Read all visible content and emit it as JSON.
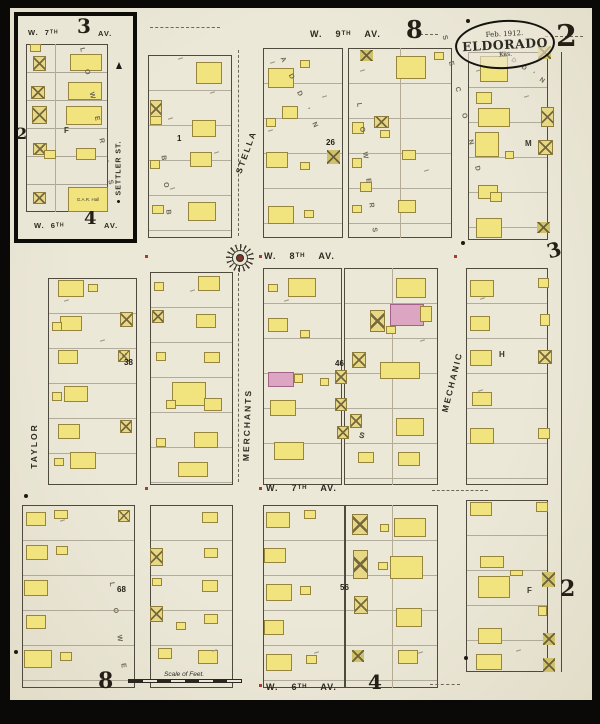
{
  "page": {
    "number": "2"
  },
  "title": {
    "date": "Feb. 1912.",
    "city": "ELDORADO",
    "state": "Kas."
  },
  "streets": {
    "w9": {
      "w": "W.",
      "n": "9ᵀᴴ",
      "av": "AV."
    },
    "w8": {
      "w": "W.",
      "n": "8ᵀᴴ",
      "av": "AV."
    },
    "w7": {
      "w": "W.",
      "n": "7ᵀᴴ",
      "av": "AV."
    },
    "w6": {
      "w": "W.",
      "n": "6ᵀᴴ",
      "av": "AV."
    },
    "w7_inset": {
      "w": "W.",
      "n": "7ᵀᴴ",
      "av": "AV."
    },
    "w6_inset": {
      "w": "W.",
      "n": "6ᵀᴴ",
      "av": "AV."
    }
  },
  "vstreets": {
    "stella": "STELLA",
    "merchants": "MERCHANTS",
    "mechanic": "MECHANIC",
    "taylor": "TAYLOR",
    "settler": "SETTLER ST."
  },
  "nums": {
    "top8": "8",
    "inset3": "3",
    "inset4": "4",
    "inset2": "2",
    "right3": "3",
    "right2": "2",
    "bottom8": "8",
    "bottom4": "4",
    "n1": "1",
    "n26": "26",
    "n38": "38",
    "n46": "46",
    "n56": "56",
    "n68": "68"
  },
  "letters": {
    "m": "M",
    "h": "H",
    "s": "S",
    "f_inset": "F",
    "f_right": "F"
  },
  "subs": {
    "inset": "L O W E R ' S",
    "bob": "B O B",
    "addn_top": "A D D ' N",
    "lowers": "L O W E R S",
    "second": "S E C O N D",
    "second_addn": "A D D ' N",
    "lowe": "L O W E"
  },
  "buildings": {
    "gar_hall": "G.A.R. Hall"
  },
  "scale": {
    "label": "Scale of Feet."
  }
}
